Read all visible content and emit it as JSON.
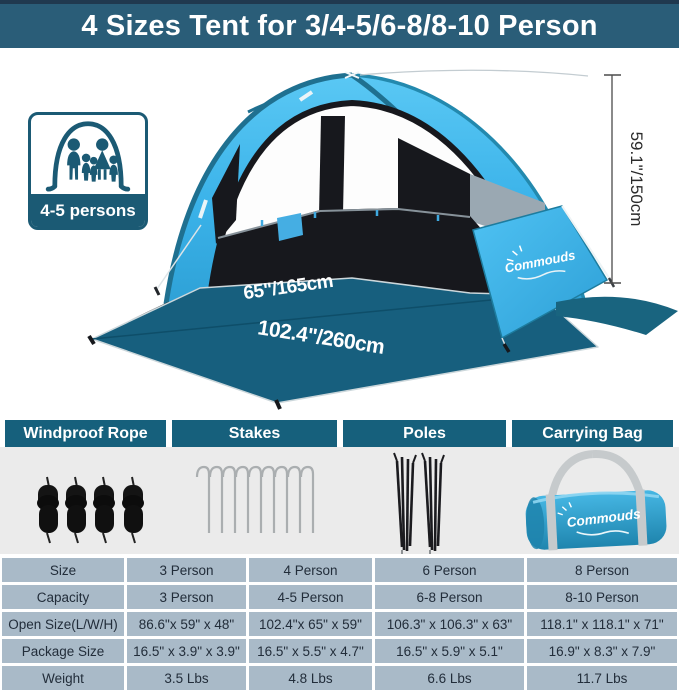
{
  "banner": {
    "title": "4 Sizes Tent for 3/4-5/6-8/8-10 Person"
  },
  "badge": {
    "label": "4-5 persons",
    "icon": "tent-family-icon"
  },
  "tent_diagram": {
    "inner_width_label": "65\"/165cm",
    "outer_width_label": "102.4\"/260cm",
    "height_label": "59.1\"/150cm",
    "brand_logo": "Commouds"
  },
  "parts": {
    "headers": [
      "Windproof Rope",
      "Stakes",
      "Poles",
      "Carrying Bag"
    ],
    "icons": [
      "rope-bundles-icon",
      "stakes-icon",
      "poles-icon",
      "carrying-bag-icon"
    ],
    "bag_logo": "Commouds"
  },
  "spec_table": {
    "header_row": [
      "Size",
      "3 Person",
      "4 Person",
      "6 Person",
      "8 Person"
    ],
    "rows": [
      {
        "label": "Capacity",
        "values": [
          "3 Person",
          "4-5 Person",
          "6-8 Person",
          "8-10 Person"
        ]
      },
      {
        "label": "Open Size(L/W/H)",
        "values": [
          "86.6\"x 59\" x 48\"",
          "102.4\"x 65\" x 59\"",
          "106.3\" x 106.3\" x 63\"",
          "118.1\" x 118.1\" x 71\""
        ]
      },
      {
        "label": "Package Size",
        "values": [
          "16.5\" x 3.9\" x 3.9\"",
          "16.5\" x 5.5\" x 4.7\"",
          "16.5\" x 5.9\" x 5.1\"",
          "16.9\" x 8.3\" x 7.9\""
        ]
      },
      {
        "label": "Weight",
        "values": [
          "3.5 Lbs",
          "4.8 Lbs",
          "6.6 Lbs",
          "11.7 Lbs"
        ]
      }
    ]
  },
  "colors": {
    "banner_bg": "#2a5d78",
    "banner_top_border": "#20394f",
    "section_header_bg": "#16607c",
    "badge_teal": "#1b5a74",
    "canopy_blue": "#3db6ec",
    "floor_teal": "#175f7e",
    "interior_dark": "#17181d",
    "parts_band_bg": "#ebebeb",
    "table_cell_bg": "#a9bac8",
    "bag_blue": "#2b9cc9"
  }
}
